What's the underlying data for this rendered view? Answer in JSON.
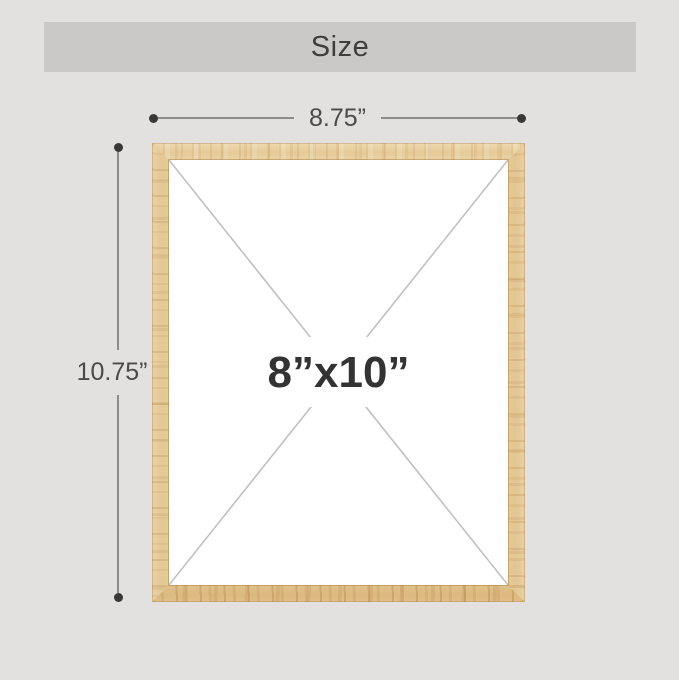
{
  "header": {
    "title": "Size"
  },
  "dimensions": {
    "width_label": "8.75”",
    "height_label": "10.75”",
    "size_label": "8”x10”"
  },
  "colors": {
    "background": "#e2e1e0",
    "banner": "#cac9c8",
    "title_text": "#3e3e3e",
    "dimension_text": "#4a4a4a",
    "dimension_line": "#8c8c8c",
    "dimension_dot": "#383838",
    "diagonal_line": "#c1c1c1",
    "size_text": "#333333",
    "wood_light": "#ead5a9",
    "wood_dark": "#dcb97e",
    "photo_area": "#ffffff"
  }
}
